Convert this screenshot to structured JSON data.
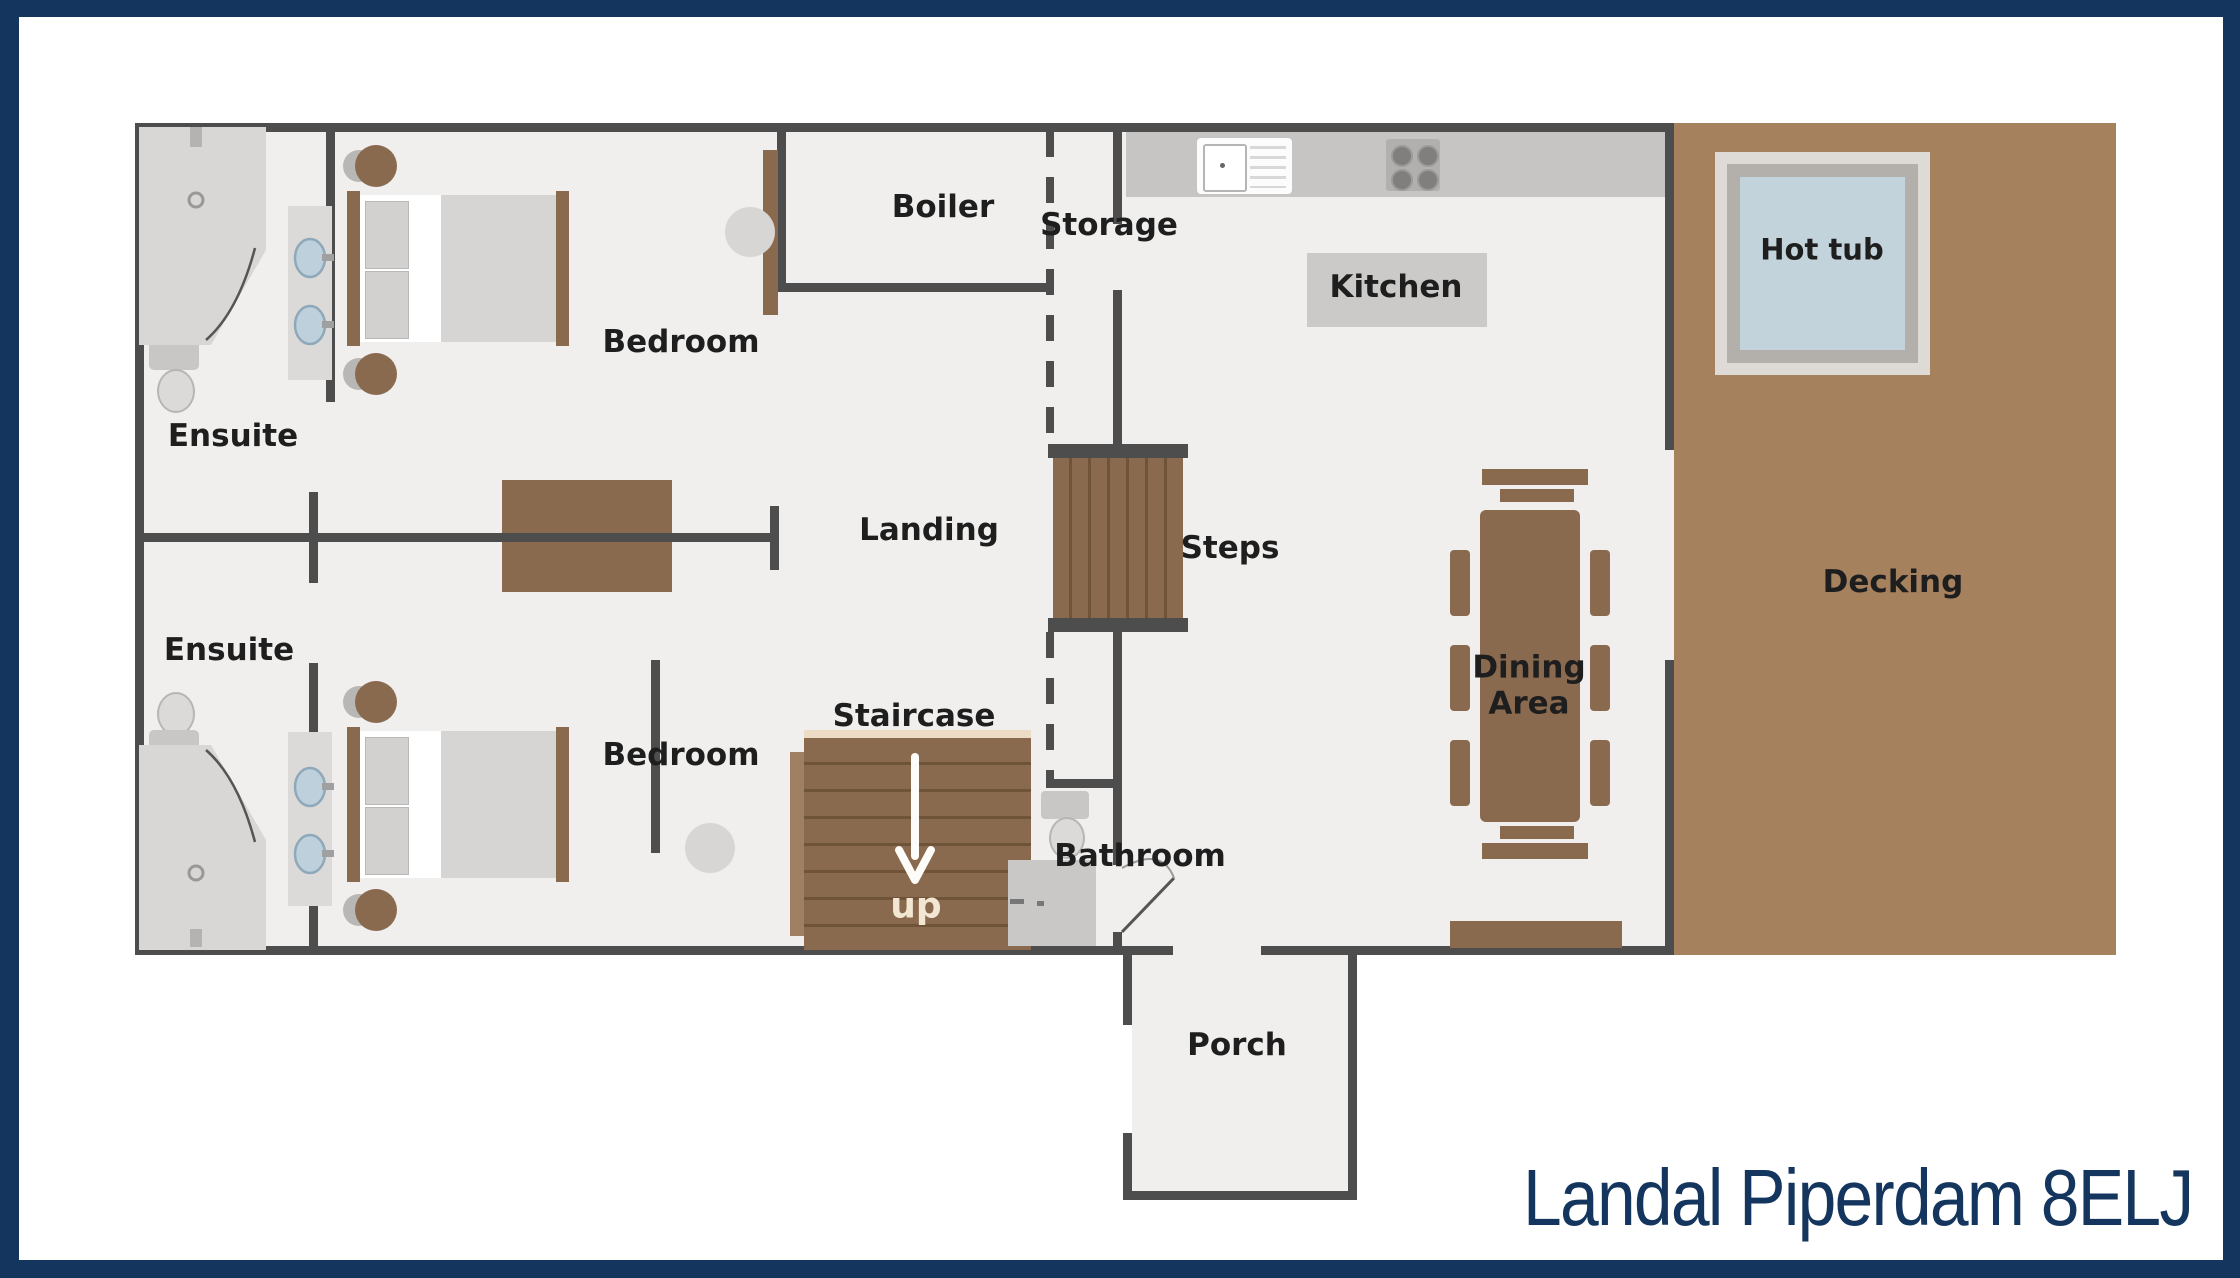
{
  "title": "Landal Piperdam 8ELJ",
  "labels": {
    "boiler": "Boiler",
    "storage": "Storage",
    "bedroom_top": "Bedroom",
    "ensuite_top": "Ensuite",
    "landing": "Landing",
    "steps": "Steps",
    "kitchen": "Kitchen",
    "hot_tub": "Hot tub",
    "decking": "Decking",
    "ensuite_bottom": "Ensuite",
    "bedroom_bottom": "Bedroom",
    "staircase": "Staircase",
    "bathroom": "Bathroom",
    "up": "up",
    "porch": "Porch",
    "dining_area": "Dining Area"
  },
  "colors": {
    "frame_navy": "#14355e",
    "wall_gray": "#4d4d4d",
    "floor_gray": "#f0efee",
    "decking_brown": "#a5815e",
    "furniture_wood": "#8a6a4f",
    "hot_tub_water": "#c3d3db",
    "title_text": "#14355e"
  }
}
